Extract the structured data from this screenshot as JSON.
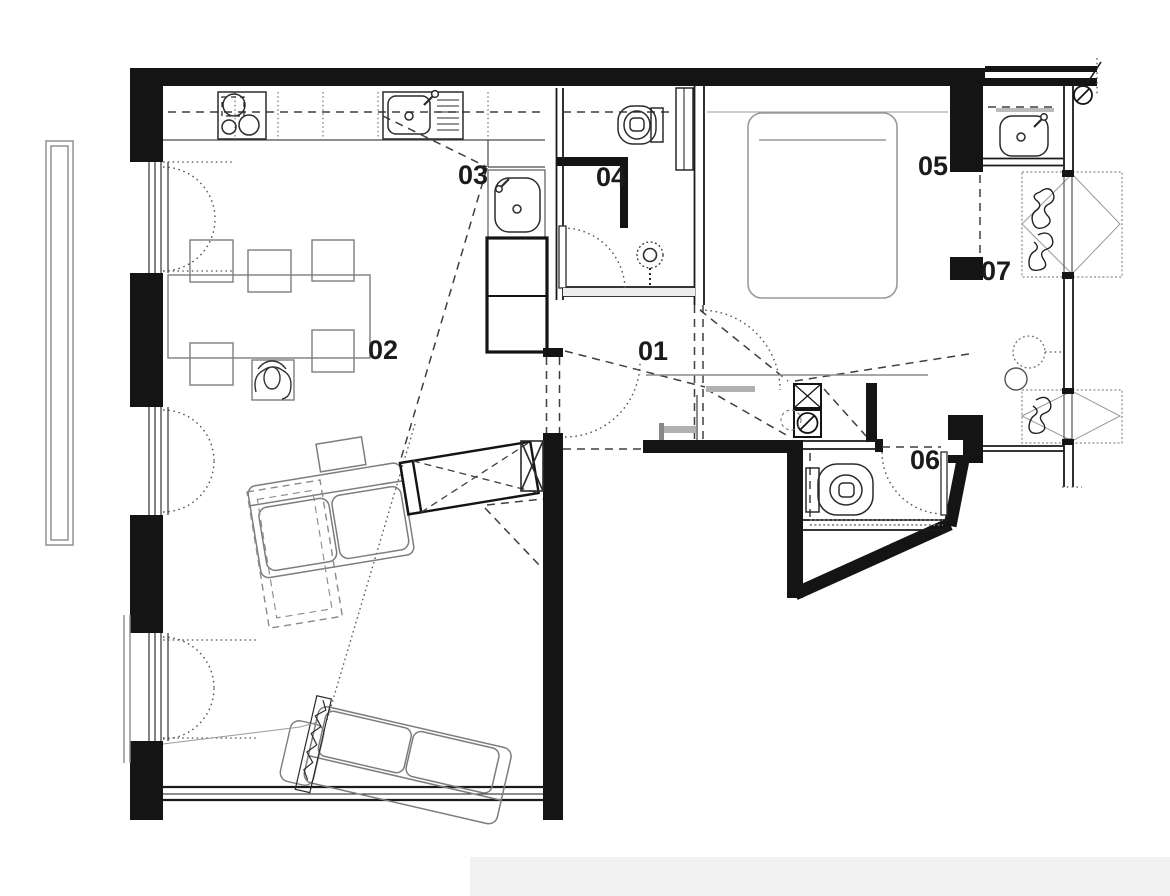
{
  "page": {
    "title": "Apartment floor plan drawing"
  },
  "colors": {
    "wall": "#141414",
    "furniture_line": "#7d7d7d",
    "fixture_line": "#2b2b2b",
    "dashed_line": "#3f3f3f",
    "dotted_line": "#555555",
    "paper": "#ffffff"
  },
  "room_labels": [
    {
      "text": "01"
    },
    {
      "text": "02"
    },
    {
      "text": "03"
    },
    {
      "text": "04"
    },
    {
      "text": "05"
    },
    {
      "text": "06"
    },
    {
      "text": "07"
    }
  ],
  "fixtures": [
    "gas-hob",
    "kitchen-sink",
    "utility-sink",
    "tall-cabinet",
    "dining-table",
    "dining-chair",
    "seated-person",
    "toilet",
    "shower-head",
    "double-bed",
    "hand-basin",
    "wardrobe",
    "washing-machine",
    "duct-shaft",
    "sofa",
    "tv-partition",
    "side-table",
    "plant",
    "balcony",
    "french-window"
  ]
}
